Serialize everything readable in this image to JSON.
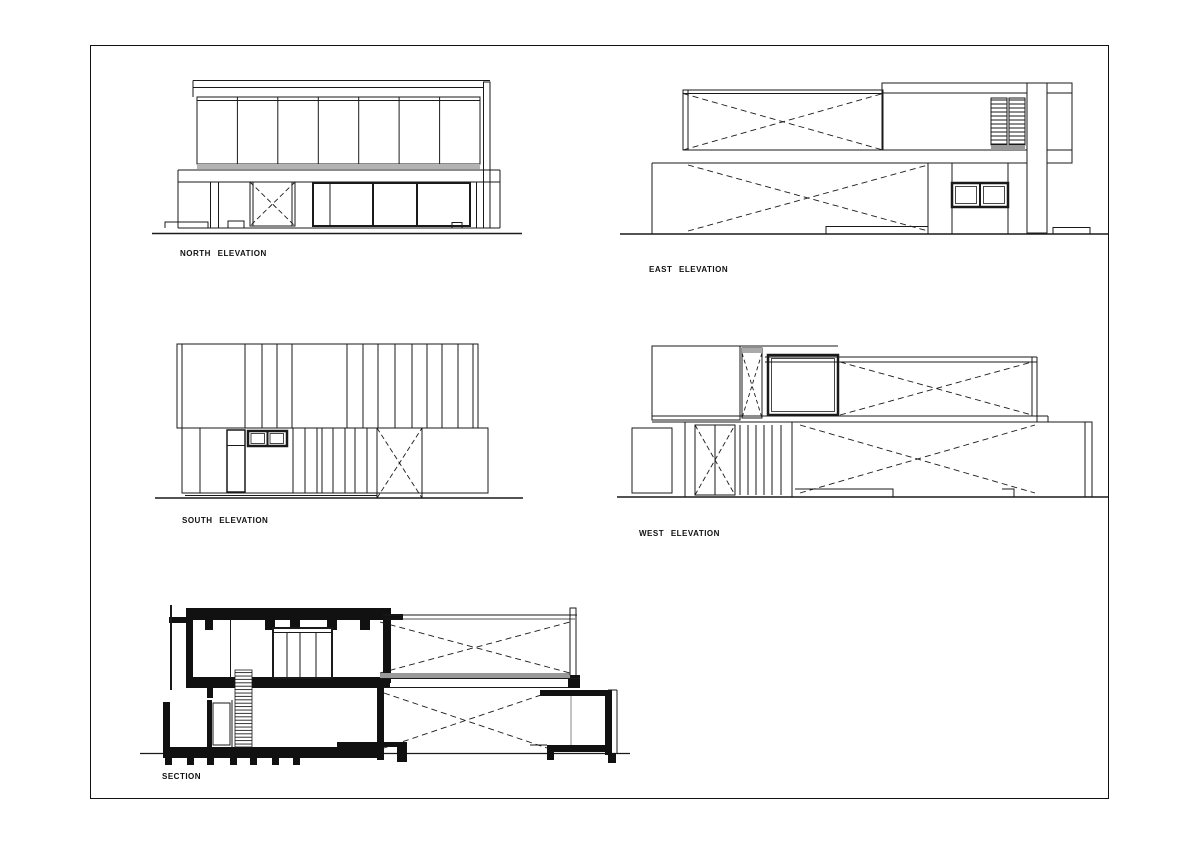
{
  "sheet": {
    "background_color": "#ffffff",
    "line_color": "#1a1a1a",
    "sill_gray": "#999999",
    "drawings": [
      {
        "id": "north-elevation",
        "label": "NORTH ELEVATION"
      },
      {
        "id": "east-elevation",
        "label": "EAST ELEVATION"
      },
      {
        "id": "south-elevation",
        "label": "SOUTH ELEVATION"
      },
      {
        "id": "west-elevation",
        "label": "WEST ELEVATION"
      },
      {
        "id": "section",
        "label": "SECTION"
      }
    ]
  }
}
